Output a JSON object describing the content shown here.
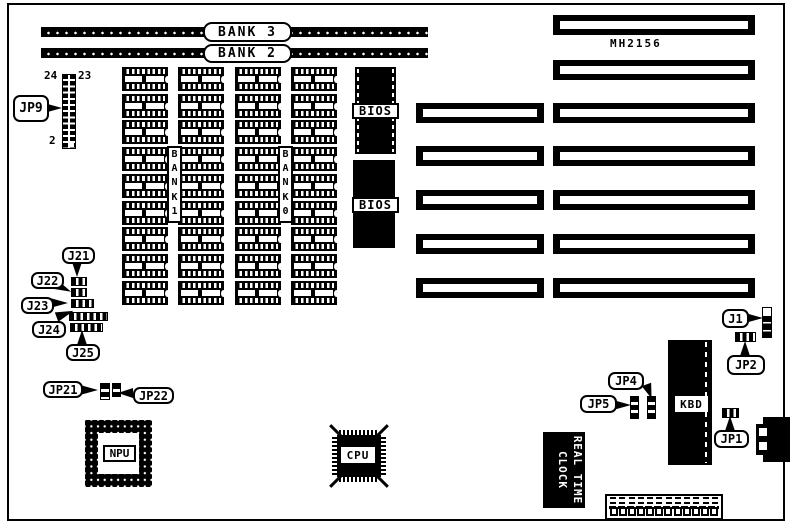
{
  "board": {
    "model": "MH2156",
    "ink_color": "#000000",
    "background_color": "#ffffff"
  },
  "simm_banks": [
    {
      "label": "BANK 3"
    },
    {
      "label": "BANK 2"
    }
  ],
  "dram": {
    "grid": {
      "columns": 4,
      "rows": 9
    },
    "bank_labels": [
      {
        "label": "BANK1"
      },
      {
        "label": "BANK0"
      }
    ]
  },
  "bios_chips": [
    {
      "label": "BIOS"
    },
    {
      "label": "BIOS"
    }
  ],
  "slots": {
    "left_count": 5,
    "right_count": 7
  },
  "jp9": {
    "label": "JP9",
    "pin_top_left": "24",
    "pin_top_right": "23",
    "pin_bottom": "2",
    "pin_rows": 12,
    "pin_cols": 2
  },
  "jumpers": {
    "j21": "J21",
    "j22": "J22",
    "j23": "J23",
    "j24": "J24",
    "j25": "J25",
    "jp21": "JP21",
    "jp22": "JP22",
    "jp4": "JP4",
    "jp5": "JP5",
    "j1": "J1",
    "jp2": "JP2",
    "jp1": "JP1"
  },
  "chips": {
    "npu": "NPU",
    "cpu": "CPU",
    "kbd": "KBD"
  },
  "rtc": {
    "line1": "REAL TIME",
    "line2": "CLOCK"
  },
  "power_connector": {
    "pin_count": 12
  }
}
